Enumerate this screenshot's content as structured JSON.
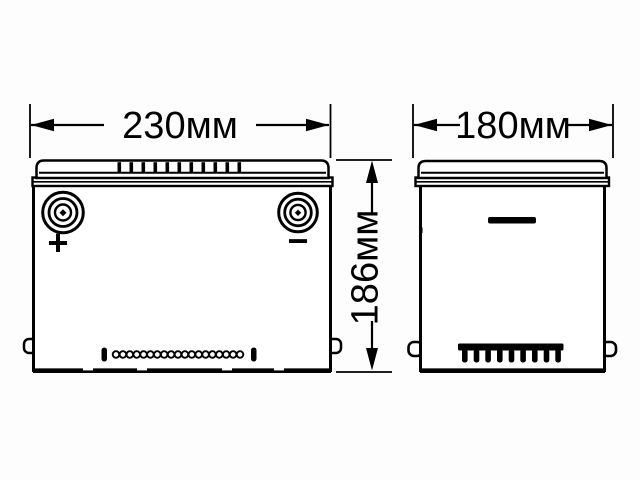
{
  "colors": {
    "ink": "#000000",
    "background": "#fdfdfd"
  },
  "dimensions": {
    "front_width": "230мм",
    "side_width": "180мм",
    "height": "186мм"
  },
  "terminals": {
    "positive": "+",
    "negative": "−"
  }
}
